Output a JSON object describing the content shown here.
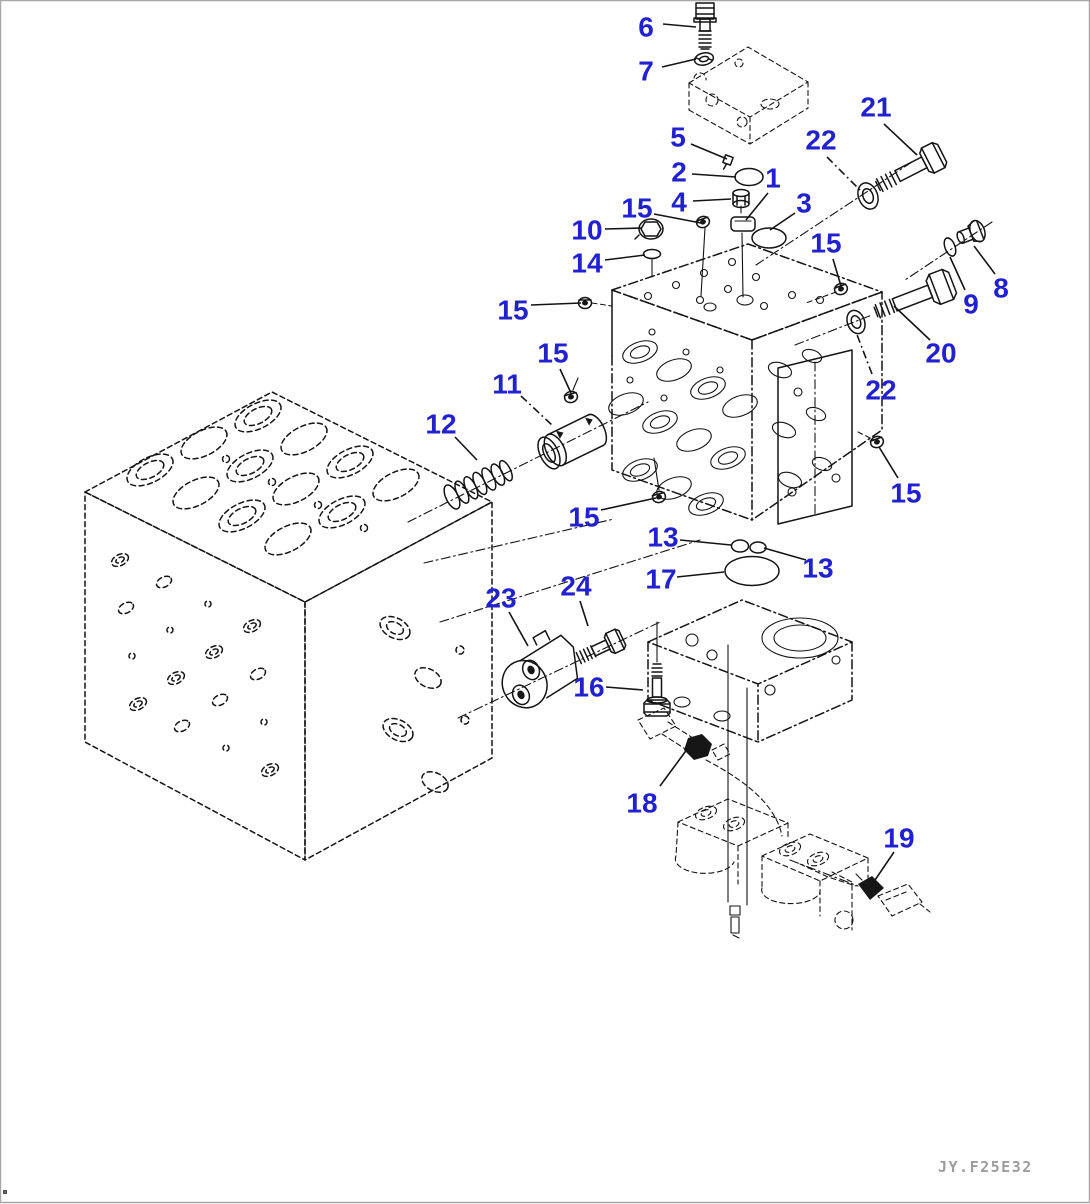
{
  "page": {
    "width": 1090,
    "height": 1204,
    "background": "#ffffff",
    "frame_color": "#a8a8a8"
  },
  "colors": {
    "label_blue": "#2121cf",
    "line": "#141414",
    "watermark_gray": "#9c9c9c"
  },
  "footer": {
    "drawing_number": "JY.F25E32"
  },
  "callouts": [
    {
      "label": "6",
      "x": 646,
      "y": 27,
      "dash": false,
      "leader": [
        [
          663,
          24
        ],
        [
          696,
          27
        ]
      ]
    },
    {
      "label": "7",
      "x": 646,
      "y": 71,
      "dash": false,
      "leader": [
        [
          662,
          67
        ],
        [
          696,
          59
        ]
      ]
    },
    {
      "label": "21",
      "x": 876,
      "y": 107,
      "dash": false,
      "leader": [
        [
          884,
          124
        ],
        [
          917,
          155
        ]
      ]
    },
    {
      "label": "22",
      "x": 821,
      "y": 140,
      "dash": true,
      "leader": [
        [
          827,
          157
        ],
        [
          860,
          190
        ]
      ]
    },
    {
      "label": "5",
      "x": 678,
      "y": 137,
      "dash": false,
      "leader": [
        [
          691,
          144
        ],
        [
          727,
          159
        ]
      ]
    },
    {
      "label": "2",
      "x": 679,
      "y": 172,
      "dash": false,
      "leader": [
        [
          692,
          174
        ],
        [
          736,
          177
        ]
      ]
    },
    {
      "label": "1",
      "x": 773,
      "y": 178,
      "dash": false,
      "leader": [
        [
          768,
          193
        ],
        [
          746,
          220
        ]
      ]
    },
    {
      "label": "3",
      "x": 804,
      "y": 203,
      "dash": false,
      "leader": [
        [
          795,
          213
        ],
        [
          770,
          230
        ]
      ]
    },
    {
      "label": "4",
      "x": 679,
      "y": 202,
      "dash": false,
      "leader": [
        [
          693,
          201
        ],
        [
          731,
          199
        ]
      ]
    },
    {
      "label": "15",
      "x": 637,
      "y": 208,
      "dash": false,
      "leader": [
        [
          654,
          214
        ],
        [
          701,
          223
        ]
      ]
    },
    {
      "label": "10",
      "x": 587,
      "y": 230,
      "dash": false,
      "leader": [
        [
          605,
          229
        ],
        [
          641,
          228
        ]
      ]
    },
    {
      "label": "14",
      "x": 587,
      "y": 263,
      "dash": false,
      "leader": [
        [
          605,
          260
        ],
        [
          645,
          255
        ]
      ]
    },
    {
      "label": "15",
      "x": 826,
      "y": 243,
      "dash": false,
      "leader": [
        [
          833,
          259
        ],
        [
          841,
          286
        ]
      ]
    },
    {
      "label": "8",
      "x": 1001,
      "y": 288,
      "dash": false,
      "leader": [
        [
          995,
          274
        ],
        [
          974,
          246
        ]
      ]
    },
    {
      "label": "9",
      "x": 971,
      "y": 304,
      "dash": false,
      "leader": [
        [
          965,
          290
        ],
        [
          950,
          257
        ]
      ]
    },
    {
      "label": "20",
      "x": 941,
      "y": 353,
      "dash": false,
      "leader": [
        [
          930,
          340
        ],
        [
          894,
          306
        ]
      ]
    },
    {
      "label": "15",
      "x": 513,
      "y": 310,
      "dash": false,
      "leader": [
        [
          531,
          305
        ],
        [
          581,
          303
        ]
      ]
    },
    {
      "label": "22",
      "x": 881,
      "y": 390,
      "dash": true,
      "leader": [
        [
          872,
          374
        ],
        [
          856,
          332
        ]
      ]
    },
    {
      "label": "15",
      "x": 553,
      "y": 353,
      "dash": false,
      "leader": [
        [
          560,
          369
        ],
        [
          571,
          393
        ]
      ]
    },
    {
      "label": "11",
      "x": 507,
      "y": 384,
      "dash": true,
      "leader": [
        [
          521,
          396
        ],
        [
          553,
          426
        ]
      ]
    },
    {
      "label": "12",
      "x": 441,
      "y": 424,
      "dash": false,
      "leader": [
        [
          455,
          437
        ],
        [
          477,
          460
        ]
      ]
    },
    {
      "label": "15",
      "x": 906,
      "y": 493,
      "dash": false,
      "leader": [
        [
          898,
          478
        ],
        [
          879,
          447
        ]
      ]
    },
    {
      "label": "15",
      "x": 584,
      "y": 517,
      "dash": false,
      "leader": [
        [
          601,
          510
        ],
        [
          656,
          498
        ]
      ]
    },
    {
      "label": "13",
      "x": 663,
      "y": 537,
      "dash": false,
      "leader": [
        [
          680,
          540
        ],
        [
          731,
          545
        ]
      ]
    },
    {
      "label": "13",
      "x": 818,
      "y": 568,
      "dash": false,
      "leader": [
        [
          764,
          548
        ],
        [
          806,
          560
        ]
      ]
    },
    {
      "label": "17",
      "x": 661,
      "y": 579,
      "dash": false,
      "leader": [
        [
          677,
          577
        ],
        [
          724,
          572
        ]
      ]
    },
    {
      "label": "23",
      "x": 501,
      "y": 598,
      "dash": false,
      "leader": [
        [
          509,
          612
        ],
        [
          528,
          646
        ]
      ]
    },
    {
      "label": "24",
      "x": 576,
      "y": 586,
      "dash": false,
      "leader": [
        [
          580,
          601
        ],
        [
          588,
          626
        ]
      ]
    },
    {
      "label": "16",
      "x": 589,
      "y": 687,
      "dash": false,
      "leader": [
        [
          606,
          687
        ],
        [
          643,
          690
        ]
      ]
    },
    {
      "label": "18",
      "x": 642,
      "y": 803,
      "dash": false,
      "leader": [
        [
          660,
          786
        ],
        [
          688,
          748
        ]
      ]
    },
    {
      "label": "19",
      "x": 899,
      "y": 838,
      "dash": false,
      "leader": [
        [
          894,
          852
        ],
        [
          871,
          886
        ]
      ]
    }
  ]
}
